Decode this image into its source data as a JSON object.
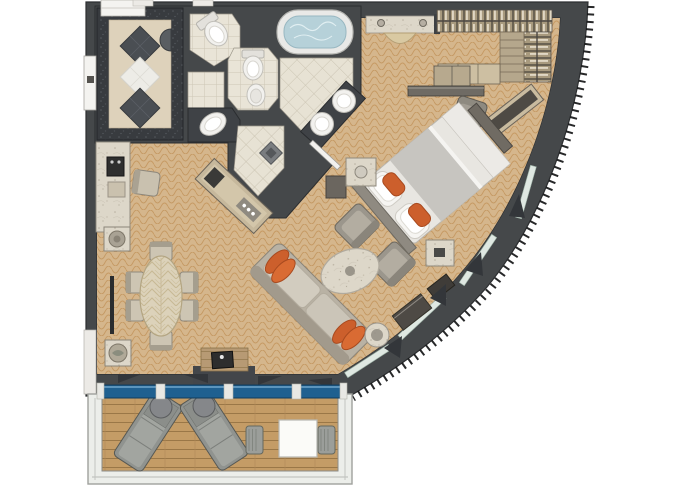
{
  "meta": {
    "type": "suite-floor-plan",
    "view": "top-down-illustrated",
    "description": "Top-down illustrated floor plan of a curved-hull suite with entry foyer, bathrooms, walk-in closet, bedroom, living-dining area and private balcony"
  },
  "palette": {
    "background": "#ffffff",
    "wall": "#45484a",
    "wall_outline": "#2c2e30",
    "granite_border": "#383b3f",
    "carpet_base": "#d5b68c",
    "carpet_lattice": "#bf8f55",
    "tile_base": "#e9e4d7",
    "tile_grout": "#cdc6b5",
    "deck_wood": "#c49c66",
    "deck_line": "#9a7747",
    "glass_blue": "#1f6090",
    "window_glass": "#dfe8e2",
    "marble": "#ddd7c9",
    "fixture_white": "#f2f1ee",
    "tub_water": "#b6d1d9",
    "accent_orange": "#cc5f2c",
    "furniture_gray": "#9b968c",
    "table_wood": "#dcd2ba"
  },
  "rooms": [
    {
      "name": "entry-foyer",
      "floor": "marble with diamond inlay"
    },
    {
      "name": "water-closet-1",
      "floor": "tile"
    },
    {
      "name": "shower-room",
      "floor": "tile"
    },
    {
      "name": "water-closet-2",
      "floor": "tile"
    },
    {
      "name": "master-bathroom",
      "floor": "diagonal tile"
    },
    {
      "name": "walk-in-closet",
      "floor": "carpet"
    },
    {
      "name": "bedroom",
      "floor": "carpet"
    },
    {
      "name": "living-dining-room",
      "floor": "carpet"
    },
    {
      "name": "balcony",
      "floor": "wood deck"
    }
  ],
  "fixtures": {
    "bathtub": 1,
    "toilets": 2,
    "bidet": 1,
    "washbasins": 3,
    "shower_drain": 1
  },
  "furniture": {
    "bedroom": [
      "king-bed",
      "nightstand-left",
      "nightstand-right",
      "foot-bench",
      "desk",
      "desk-chair",
      "wall-shelves",
      "luggage-bench",
      "minibar-cabinet",
      "vanity-counter",
      "vanity-stool",
      "hanging-rod-top",
      "hanging-rod-side",
      "closet-shelves",
      "closet-drawers"
    ],
    "living_dining": [
      "sofa",
      "armchair-1",
      "armchair-2",
      "coffee-table",
      "side-table",
      "dining-table",
      "dining-chairs-x6",
      "bar-counter",
      "coffee-machine",
      "bar-stool",
      "planter-north",
      "planter-south",
      "media-console",
      "tv",
      "corridor-console"
    ],
    "balcony": [
      "lounger-1",
      "lounger-2",
      "round-table-1",
      "round-table-2",
      "outdoor-table",
      "outdoor-chair-left",
      "outdoor-chair-right"
    ]
  },
  "counts": {
    "orange_accent_pillows_bed": 2,
    "orange_accent_pillows_sofa": 4,
    "dining_chairs": 6,
    "balcony_loungers": 2
  }
}
